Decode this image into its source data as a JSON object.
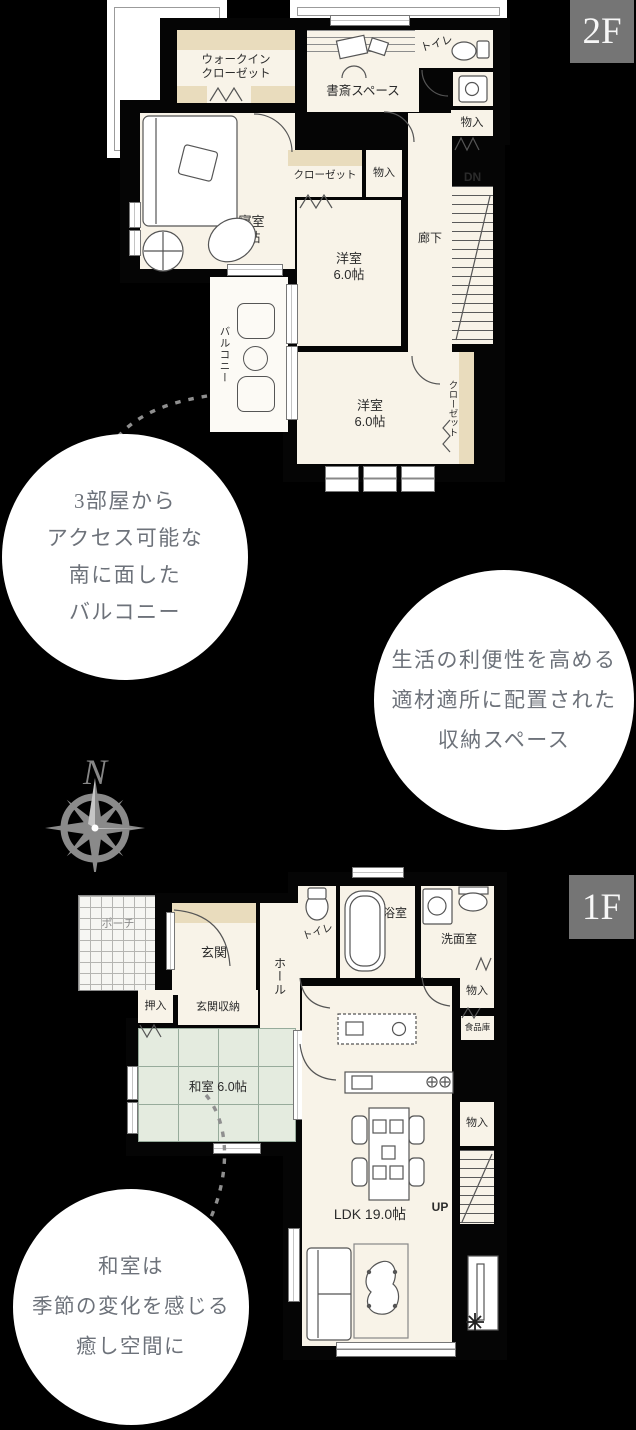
{
  "badges": {
    "floor2": "2F",
    "floor1": "1F"
  },
  "compass": {
    "north": "N"
  },
  "floor2": {
    "rooms": {
      "walk_in_closet": "ウォークイン\nクローゼット",
      "study_space": "書斎スペース",
      "toilet": "トイレ",
      "storage_top": "物入",
      "closet_bedroom": "クローゼット",
      "storage_mid": "物入",
      "master_bedroom": "主寝室\n8.0帖",
      "corridor": "廊下",
      "stairs_down": "DN",
      "western_room_north": "洋室\n6.0帖",
      "western_room_south": "洋室\n6.0帖",
      "closet_south": "クローゼット",
      "balcony": "バルコニー"
    }
  },
  "floor1": {
    "rooms": {
      "porch": "ポーチ",
      "entrance": "玄関",
      "hall": "ホール",
      "toilet": "トイレ",
      "bathroom": "浴室",
      "washroom": "洗面室",
      "storage_wash": "物入",
      "pantry": "食品庫",
      "oshiire": "押入",
      "entrance_storage": "玄関収納",
      "japanese_room": "和室 6.0帖",
      "ldk": "LDK 19.0帖",
      "storage_ldk": "物入",
      "stairs_up": "UP"
    }
  },
  "annotations": {
    "balcony_note": "3部屋から\nアクセス可能な\n南に面した\nバルコニー",
    "storage_note": "生活の利便性を高める\n適材適所に配置された\n収納スペース",
    "washitsu_note": "和室は\n季節の変化を感じる\n癒し空間に"
  },
  "colors": {
    "floor": "#f8f3e8",
    "closet_shelf": "#e9dcbd",
    "tatami": "#e4ebdf",
    "badge_bg": "#757575",
    "note_text": "#6d727a"
  }
}
